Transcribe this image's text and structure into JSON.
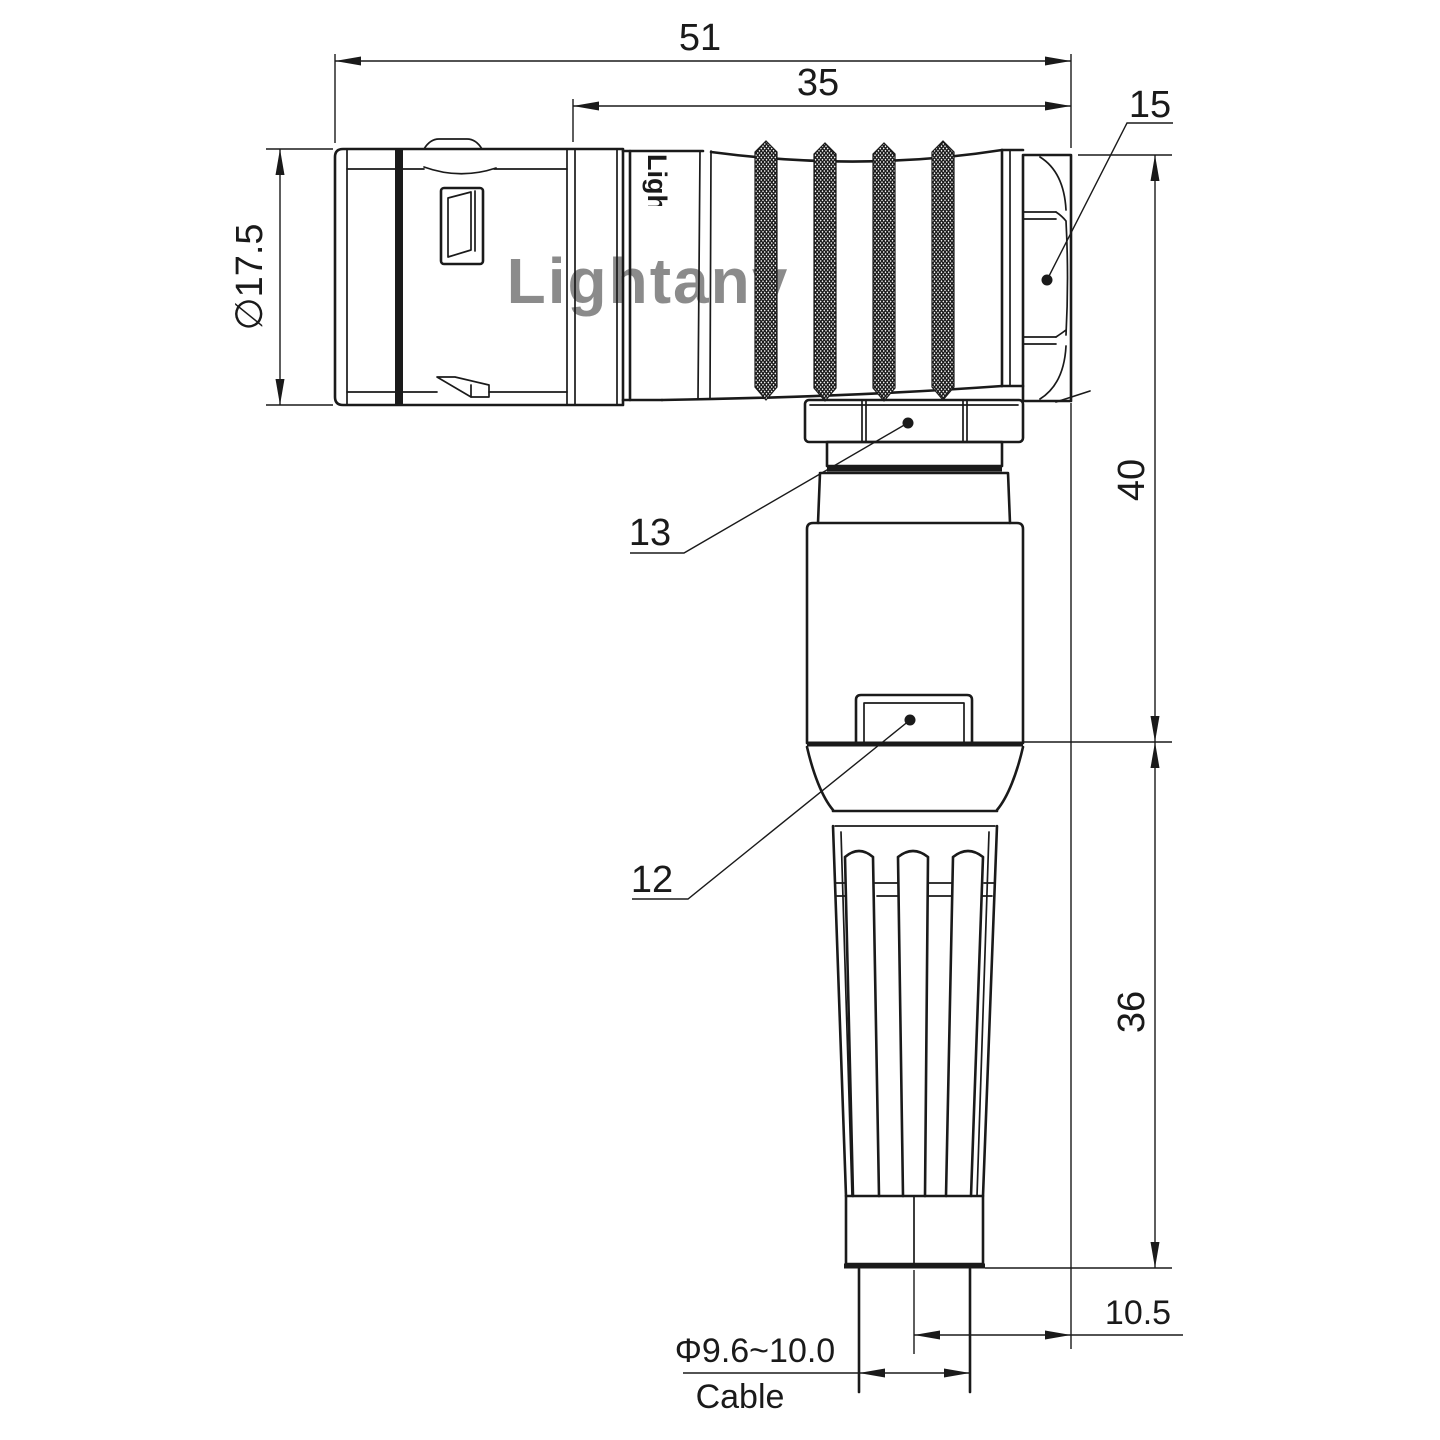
{
  "colors": {
    "line": "#1a1a1a",
    "background": "#ffffff",
    "watermark_pink": "#e89f9f"
  },
  "dimensions": {
    "total_length": "51",
    "rear_section_length": "35",
    "hex_nut_label": "15",
    "plug_diameter": "∅17.5",
    "elbow_height": "40",
    "boot_height": "36",
    "backnut_label": "13",
    "body_label": "12",
    "cable_offset": "10.5",
    "cable_diameter": "Φ9.6~10.0",
    "cable_caption": "Cable"
  },
  "watermark": {
    "brand": "Lightany",
    "engraving": "Lightany"
  }
}
